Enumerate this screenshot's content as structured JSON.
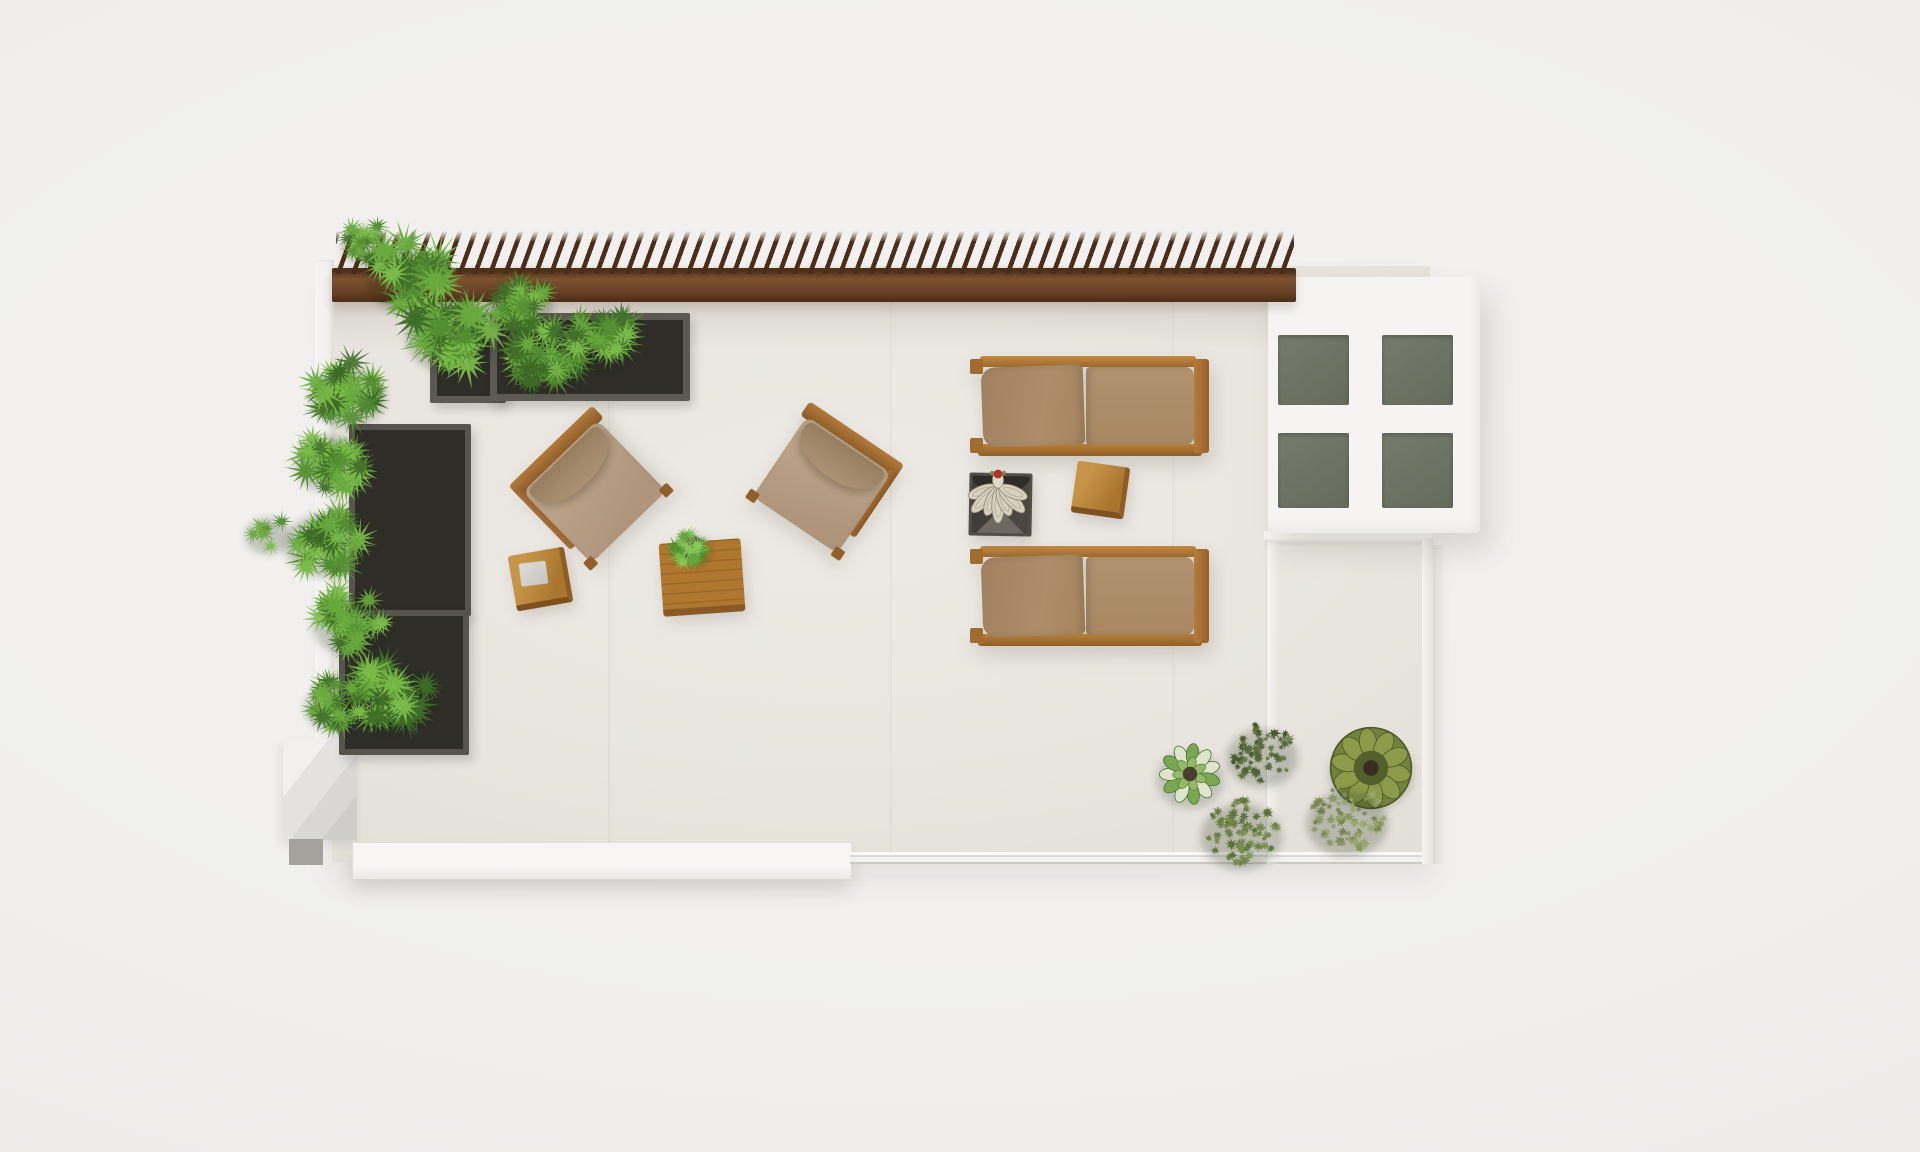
{
  "scene": {
    "type": "photorealistic 3d render, top-down view",
    "subject": "rooftop terrace with pergola, planters, sun loungers and lounge furniture",
    "canvas": {
      "width": 1920,
      "height": 1152
    },
    "palette": {
      "background": "#f0efed",
      "terrace_floor": "#e8e5df",
      "parapet_white": "#f5f4f2",
      "pergola_beam_wood": "#6a4226",
      "pergola_slat_wood": "#4b2d19",
      "planter_gray": "#5c5a53",
      "planter_soil": "#2e2d28",
      "foliage_green": "#558f33",
      "cushion_tan": "#ab8b67",
      "frame_wood": "#b0772f",
      "skylight_frame": "#f5f4f2",
      "skylight_glass": "#6d7164",
      "succulent_cream": "#d8d0bf",
      "accent_red": "#b23128"
    },
    "objects": [
      {
        "name": "terrace-floor",
        "kind": "stone tile deck",
        "color": "#e8e5df"
      },
      {
        "name": "pergola",
        "kind": "wood beam with 67 angled slats along top edge",
        "colors": [
          "#7c5230",
          "#4b2d19"
        ]
      },
      {
        "name": "skylight-window",
        "kind": "white skylight with 4 gray glass panes",
        "colors": [
          "#f5f4f2",
          "#6d7164"
        ]
      },
      {
        "name": "planter-boxes",
        "kind": "4 gray planter boxes (2 along top wall, 2 along left wall) with fern shrubs",
        "color": "#5c5a53"
      },
      {
        "name": "sun-loungers",
        "kind": "2 wood sun loungers with tan two-part cushions",
        "colors": [
          "#b0772f",
          "#ab8b67"
        ]
      },
      {
        "name": "armchairs",
        "kind": "2 rotated lounge armchairs with tan cushions facing a coffee table",
        "colors": [
          "#b27a3c",
          "#b39a81"
        ]
      },
      {
        "name": "coffee-table",
        "kind": "plank-wood coffee table with small potted plant",
        "color": "#b0782f"
      },
      {
        "name": "cube-stool",
        "kind": "wood cube stool with folded gray towel",
        "color": "#c79548"
      },
      {
        "name": "side-table-cube",
        "kind": "wood cube side table between loungers",
        "color": "#c79548"
      },
      {
        "name": "succulent-tray",
        "kind": "dark square tray of cream succulents with red bloom",
        "colors": [
          "#3a3733",
          "#d8d0bf",
          "#b23128"
        ]
      },
      {
        "name": "bottom-right-plants",
        "kind": "cluster of 5 plants: variegated rosette, wavy olive succulent, 3 fluffy bushes"
      },
      {
        "name": "bottom-left-step",
        "kind": "beveled concrete step block",
        "color": "#e4e2de"
      },
      {
        "name": "bottom-parapet-ledge",
        "kind": "white parapet ledge (left) and thin glass rail (right)",
        "color": "#f7f6f4"
      }
    ],
    "foliage_clumps": [
      {
        "name": "pergola-overhang-a",
        "style": "fern",
        "cx": 366,
        "cy": 243,
        "r": 30,
        "palette": [
          "#41702a",
          "#558f33",
          "#69a93e",
          "#7bbb4a"
        ]
      },
      {
        "name": "pergola-overhang-b",
        "style": "fern",
        "cx": 408,
        "cy": 274,
        "r": 50,
        "palette": [
          "#41702a",
          "#558f33",
          "#69a93e",
          "#7bbb4a"
        ]
      },
      {
        "name": "top-planter-a",
        "style": "fern",
        "cx": 452,
        "cy": 330,
        "r": 56,
        "palette": [
          "#3d6a27",
          "#538c32",
          "#69a93e",
          "#7bbb4a"
        ]
      },
      {
        "name": "top-planter-b",
        "style": "fern",
        "cx": 520,
        "cy": 302,
        "r": 40,
        "palette": [
          "#41702a",
          "#558f33",
          "#69a93e",
          "#7bbb4a"
        ]
      },
      {
        "name": "top-planter-c",
        "style": "fern",
        "cx": 546,
        "cy": 356,
        "r": 47,
        "palette": [
          "#3d6a27",
          "#538c32",
          "#69a93e",
          "#7bbb4a"
        ]
      },
      {
        "name": "top-planter-d",
        "style": "fern",
        "cx": 600,
        "cy": 337,
        "r": 44,
        "palette": [
          "#41702a",
          "#558f33",
          "#69a93e",
          "#7bbb4a"
        ]
      },
      {
        "name": "left-wall-a",
        "style": "fern",
        "cx": 348,
        "cy": 392,
        "r": 46,
        "palette": [
          "#3d6a27",
          "#538c32",
          "#69a93e",
          "#7bbb4a"
        ]
      },
      {
        "name": "left-wall-b",
        "style": "fern",
        "cx": 331,
        "cy": 459,
        "r": 44,
        "palette": [
          "#41702a",
          "#558f33",
          "#69a93e",
          "#7bbb4a"
        ]
      },
      {
        "name": "left-wall-c",
        "style": "fern",
        "cx": 324,
        "cy": 540,
        "r": 48,
        "palette": [
          "#3d6a27",
          "#538c32",
          "#69a93e",
          "#7bbb4a"
        ]
      },
      {
        "name": "left-wall-wisp",
        "style": "fern_sparse",
        "cx": 268,
        "cy": 533,
        "r": 28,
        "palette": [
          "#538c32",
          "#69a93e",
          "#7bbb4a"
        ]
      },
      {
        "name": "left-wall-d",
        "style": "fern",
        "cx": 350,
        "cy": 620,
        "r": 46,
        "palette": [
          "#41702a",
          "#558f33",
          "#69a93e",
          "#7bbb4a"
        ]
      },
      {
        "name": "left-wall-e",
        "style": "fern",
        "cx": 392,
        "cy": 694,
        "r": 50,
        "palette": [
          "#3d6a27",
          "#538c32",
          "#69a93e",
          "#7bbb4a"
        ]
      },
      {
        "name": "left-wall-f",
        "style": "fern",
        "cx": 334,
        "cy": 704,
        "r": 36,
        "palette": [
          "#41702a",
          "#558f33",
          "#69a93e",
          "#7bbb4a"
        ]
      },
      {
        "name": "coffee-table-plant",
        "style": "fern",
        "cx": 692,
        "cy": 549,
        "r": 24,
        "palette": [
          "#4e8c2f",
          "#63a83d",
          "#79c24c",
          "#8ccf5b"
        ]
      },
      {
        "name": "br-bush-dark",
        "style": "fluff",
        "cx": 1262,
        "cy": 753,
        "r": 44,
        "palette": [
          "#46552c",
          "#556636",
          "#64753f"
        ]
      },
      {
        "name": "br-rosette-variegated",
        "style": "rosette_variegated",
        "cx": 1190,
        "cy": 774,
        "r": 36,
        "palette": [
          "#dde6cc",
          "#79a752",
          "#93bb66"
        ]
      },
      {
        "name": "br-succulent-wavy",
        "style": "rosette_wavy",
        "cx": 1371,
        "cy": 768,
        "r": 43,
        "palette": [
          "#75823c",
          "#8c9a49",
          "#555f2a"
        ]
      },
      {
        "name": "br-bush-light",
        "style": "fluff",
        "cx": 1347,
        "cy": 818,
        "r": 50,
        "palette": [
          "#74824e",
          "#86945b",
          "#98a66a"
        ]
      },
      {
        "name": "br-bush-mid",
        "style": "fluff",
        "cx": 1241,
        "cy": 831,
        "r": 50,
        "palette": [
          "#5a6d37",
          "#6a7f41",
          "#7b904c"
        ]
      },
      {
        "name": "tray-succulents",
        "style": "succulent_tray",
        "cx": 998,
        "cy": 500,
        "r": 34,
        "palette": [
          "#d8d0bf",
          "#b3ab9a",
          "#8e8674"
        ]
      }
    ]
  }
}
